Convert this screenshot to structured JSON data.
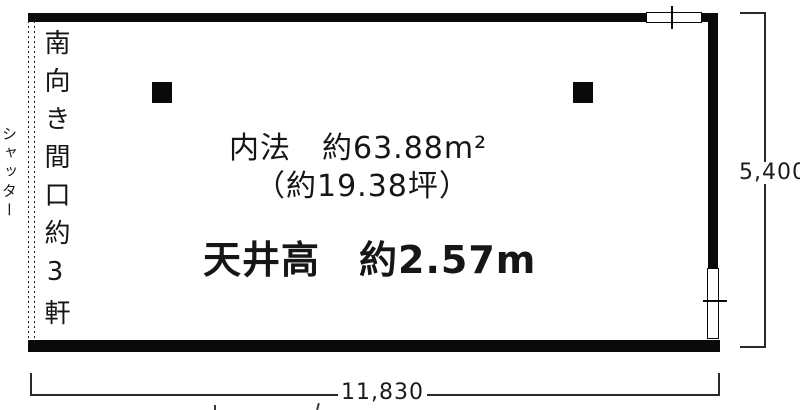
{
  "plan": {
    "room": {
      "area_line1": "内法　約63.88m²",
      "area_line2": "（約19.38坪）",
      "ceiling_line": "天井高　約2.57m"
    },
    "labels": {
      "frontage_vertical": "南向き間口約3軒",
      "shutter_vertical": "シャッター"
    },
    "dimensions": {
      "height": "5,400",
      "width": "11,830"
    },
    "colors": {
      "wall": "#0a0a0a",
      "text": "#161616",
      "background": "#ffffff"
    }
  }
}
